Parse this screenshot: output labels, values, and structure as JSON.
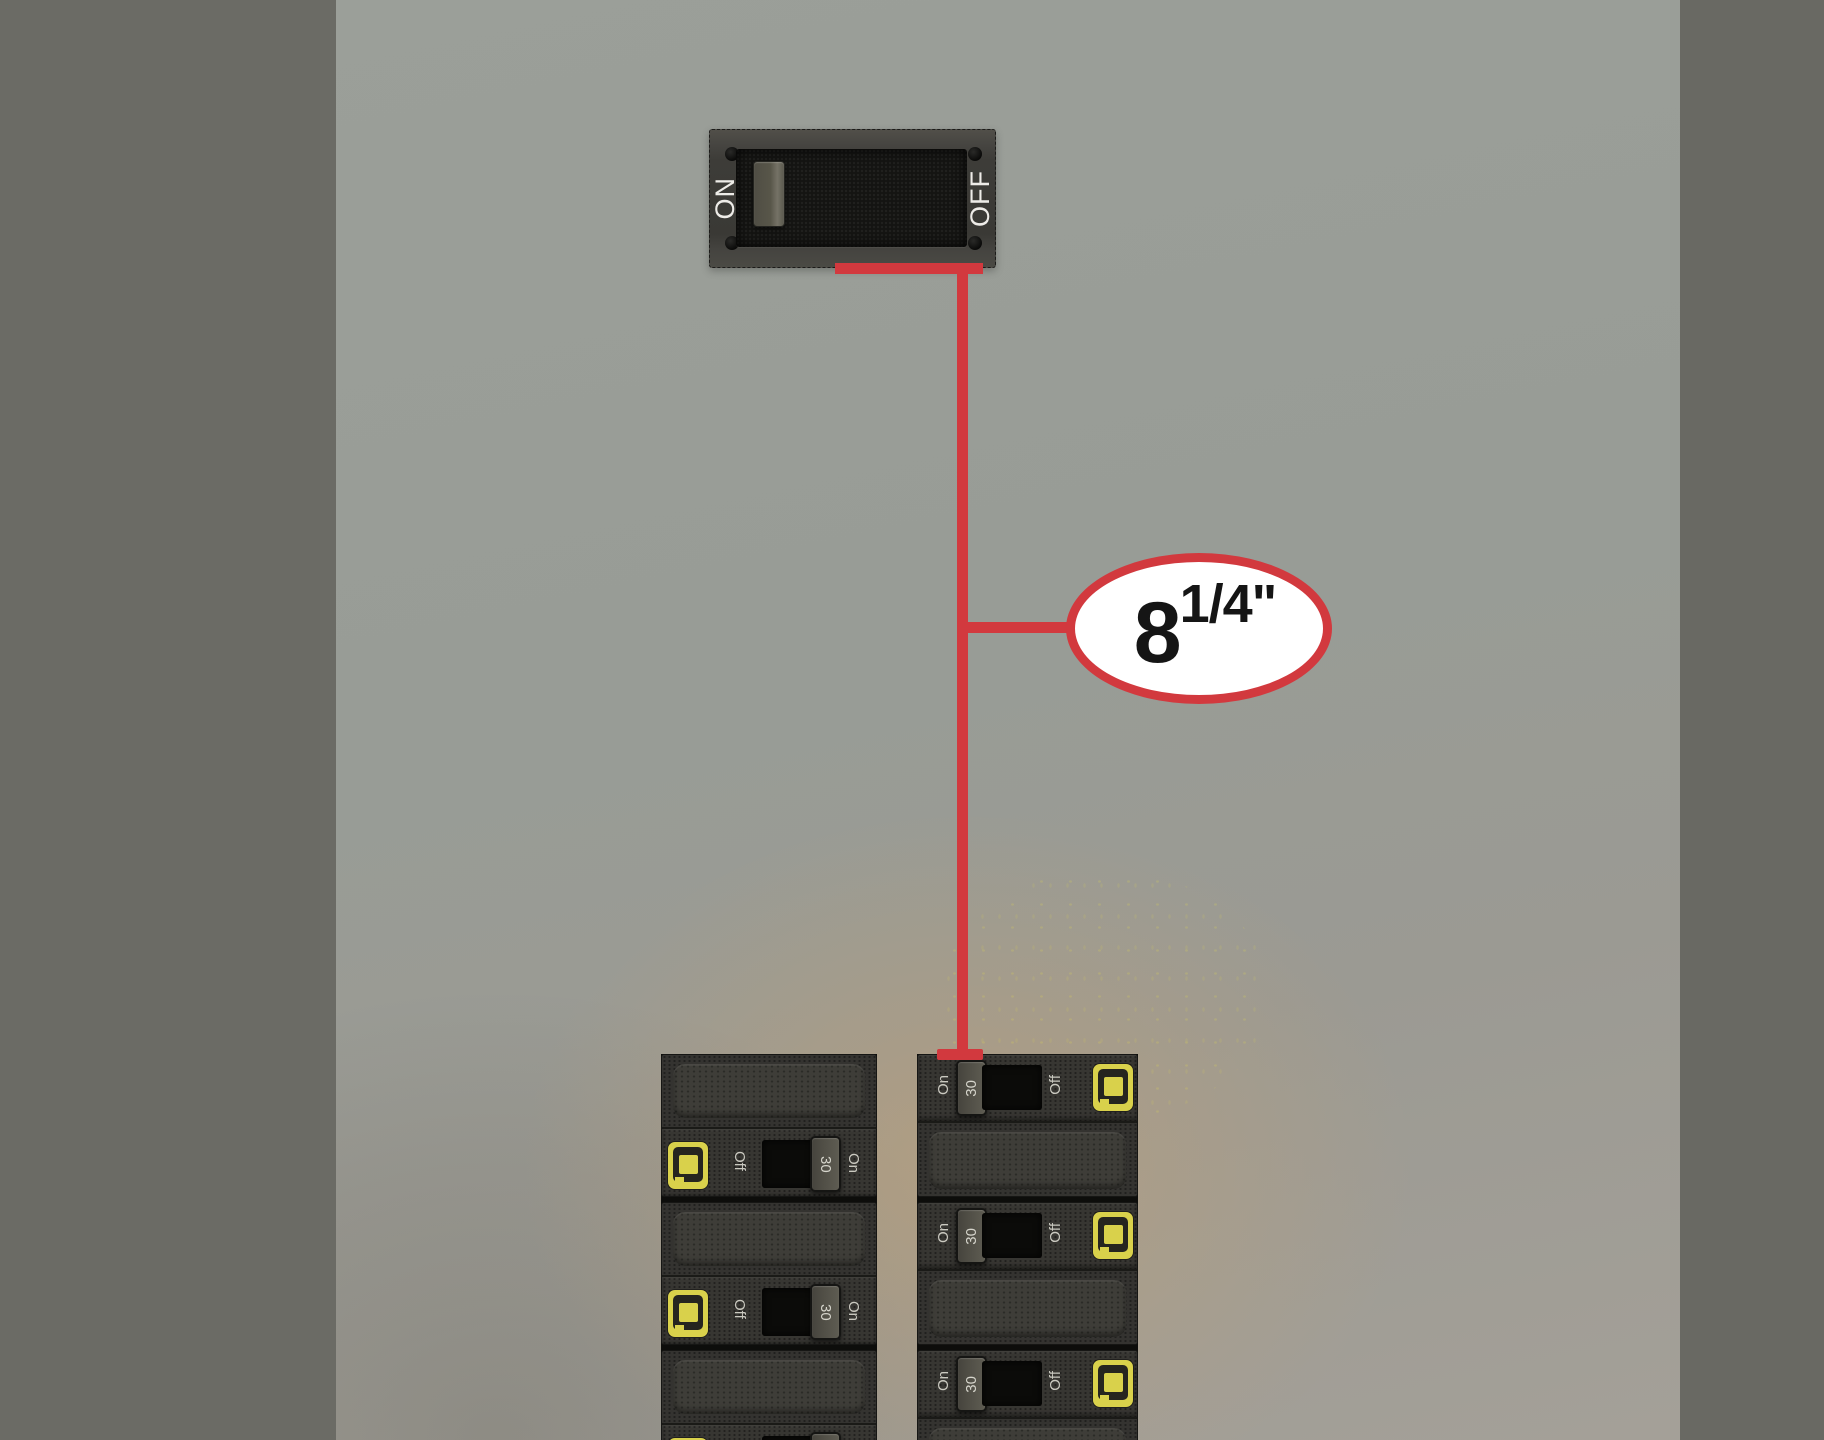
{
  "measurement_callout": {
    "whole": "8",
    "fraction": "1/4\""
  },
  "main_switch": {
    "on_label": "ON",
    "off_label": "OFF"
  },
  "breaker_columns": {
    "left": [
      {
        "off_label": "Off",
        "amp_rating": "30",
        "on_label": "On"
      },
      {
        "off_label": "Off",
        "amp_rating": "30",
        "on_label": "On"
      },
      {
        "off_label": "Off",
        "amp_rating": "30",
        "on_label": "On"
      }
    ],
    "right": [
      {
        "on_label": "On",
        "amp_rating": "30",
        "off_label": "Off"
      },
      {
        "on_label": "On",
        "amp_rating": "30",
        "off_label": "Off"
      },
      {
        "on_label": "On",
        "amp_rating": "30",
        "off_label": "Off"
      }
    ]
  },
  "colors": {
    "accent_red": "#d2393e",
    "brand_yellow": "#d9d14b",
    "background_gray": "#999d97",
    "side_bar_gray": "#6b6b65",
    "breaker_body": "#343330"
  }
}
